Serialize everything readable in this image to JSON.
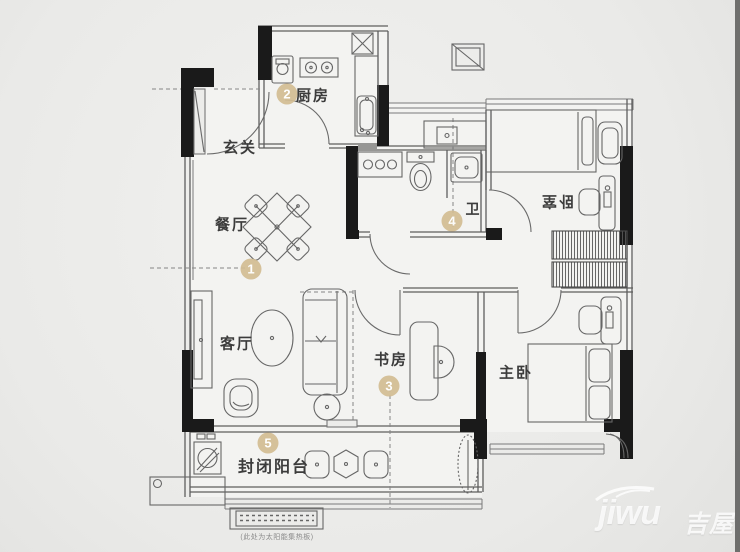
{
  "rooms": {
    "entrance": {
      "label": "玄关"
    },
    "kitchen": {
      "label": "厨房",
      "num": "2"
    },
    "dining": {
      "label": "餐厅",
      "num": "1"
    },
    "bath": {
      "label": "卫",
      "num": "4"
    },
    "bedroom": {
      "label": "卧室"
    },
    "study": {
      "label": "书房",
      "num": "3"
    },
    "living": {
      "label": "客厅"
    },
    "master": {
      "label": "主卧"
    },
    "balcony": {
      "label": "封闭阳台",
      "num": "5"
    }
  },
  "note": {
    "solar": "(此处为太阳能集热板)"
  },
  "watermark": {
    "latin": "jiwu",
    "cjk": "吉屋"
  },
  "colors": {
    "bg": "#eaeae8",
    "wall": "#1a1a1a",
    "line": "#5e5e5e",
    "marker": "#d3bd93",
    "label": "#3c3c3c"
  }
}
